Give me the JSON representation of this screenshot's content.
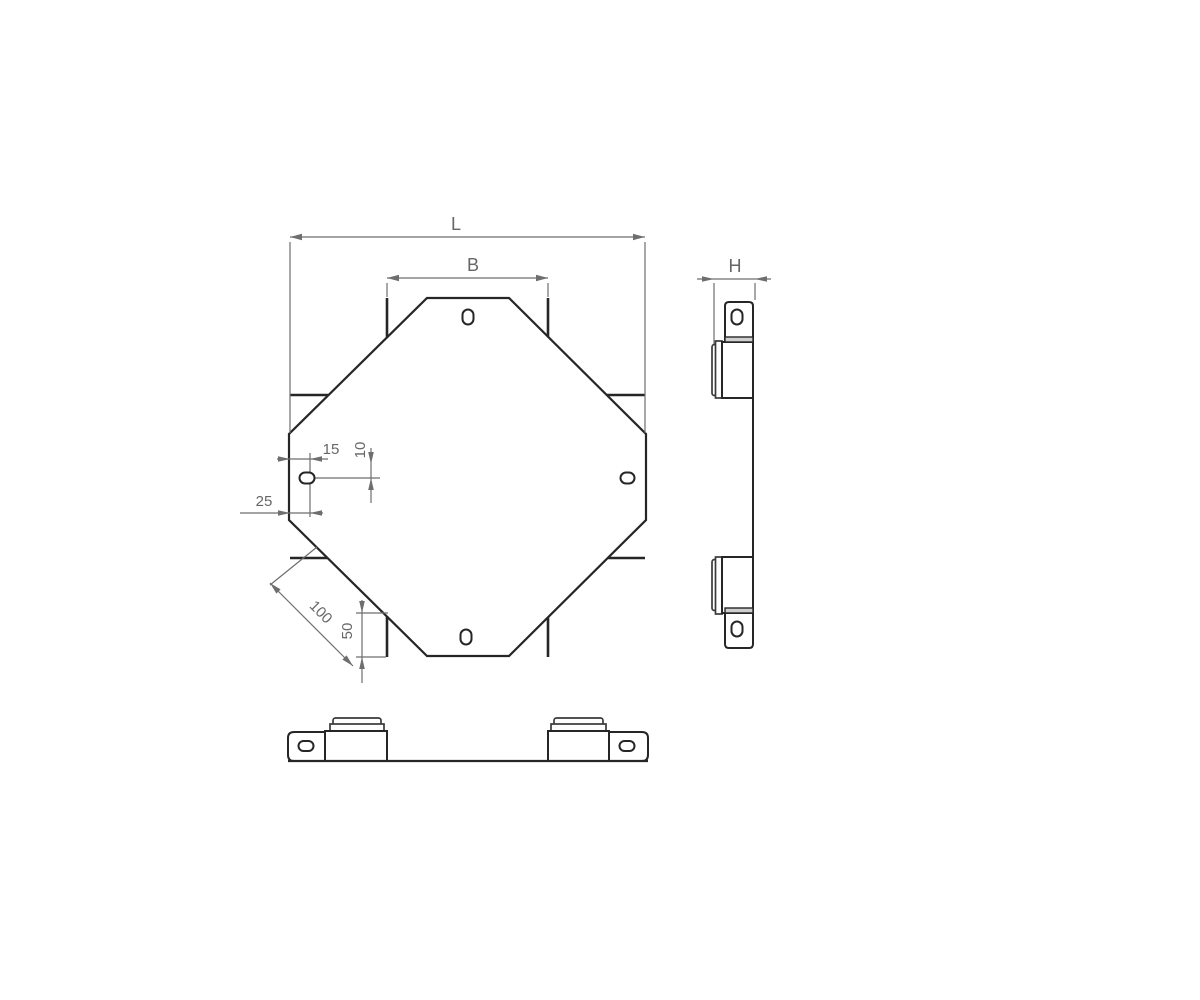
{
  "drawing": {
    "labels": {
      "length": "L",
      "width": "B",
      "height": "H",
      "slot_offset_x": "15",
      "slot_offset_y": "10",
      "edge_offset": "25",
      "corner": "100",
      "corner_half": "50"
    },
    "colors": {
      "outline": "#262626",
      "dimension": "#6e6e6e",
      "background": "#ffffff",
      "fold_fill": "#cfcfcf"
    }
  }
}
